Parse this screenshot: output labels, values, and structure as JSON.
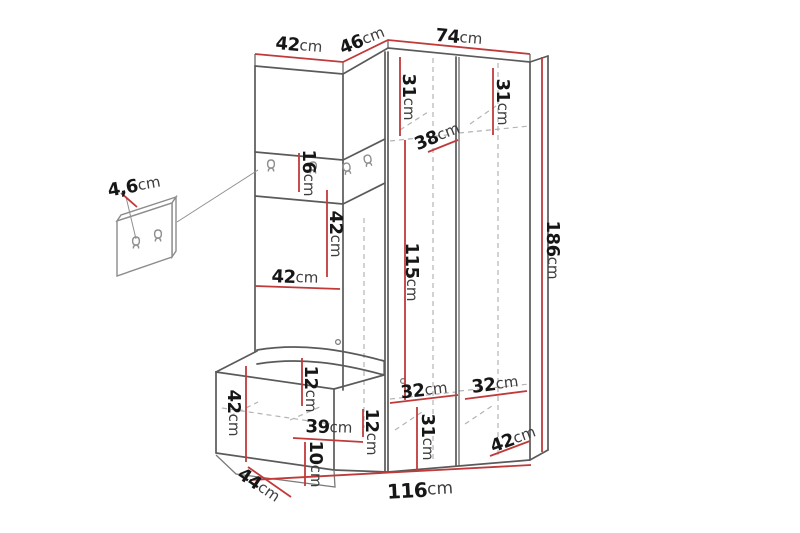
{
  "diagram": {
    "type": "furniture-dimension-drawing",
    "subject": "hallway corner wardrobe set with coat hooks, bench and wall hook panel",
    "unit": "cm",
    "colors": {
      "dim_red": "#c03a3a",
      "outline_gray": "#5a5a5a",
      "hidden_gray": "#b3b3b3",
      "background": "#ffffff"
    },
    "dims": {
      "top_left_width": {
        "v": "42",
        "u": "cm"
      },
      "corner_width": {
        "v": "46",
        "u": "cm"
      },
      "top_right_width": {
        "v": "74",
        "u": "cm"
      },
      "total_height": {
        "v": "186",
        "u": "cm"
      },
      "shelf_left_height": {
        "v": "31",
        "u": "cm"
      },
      "shelf_right_height": {
        "v": "31",
        "u": "cm"
      },
      "shelf_depth": {
        "v": "38",
        "u": "cm"
      },
      "hook_panel_height": {
        "v": "16",
        "u": "cm"
      },
      "niche_height": {
        "v": "42",
        "u": "cm"
      },
      "niche_width": {
        "v": "42",
        "u": "cm"
      },
      "inner_height": {
        "v": "115",
        "u": "cm"
      },
      "seat_thickness": {
        "v": "12",
        "u": "cm"
      },
      "bench_inner_width": {
        "v": "39",
        "u": "cm"
      },
      "bench_inner_height": {
        "v": "12",
        "u": "cm"
      },
      "plinth_height": {
        "v": "10",
        "u": "cm"
      },
      "bench_height": {
        "v": "42",
        "u": "cm"
      },
      "bench_depth": {
        "v": "44",
        "u": "cm"
      },
      "lower_left_width": {
        "v": "32",
        "u": "cm"
      },
      "lower_right_width": {
        "v": "32",
        "u": "cm"
      },
      "lower_inner_height": {
        "v": "31",
        "u": "cm"
      },
      "lower_depth": {
        "v": "42",
        "u": "cm"
      },
      "total_width": {
        "v": "116",
        "u": "cm"
      },
      "wall_panel_thickness": {
        "v": "4,6",
        "u": "cm"
      }
    }
  }
}
